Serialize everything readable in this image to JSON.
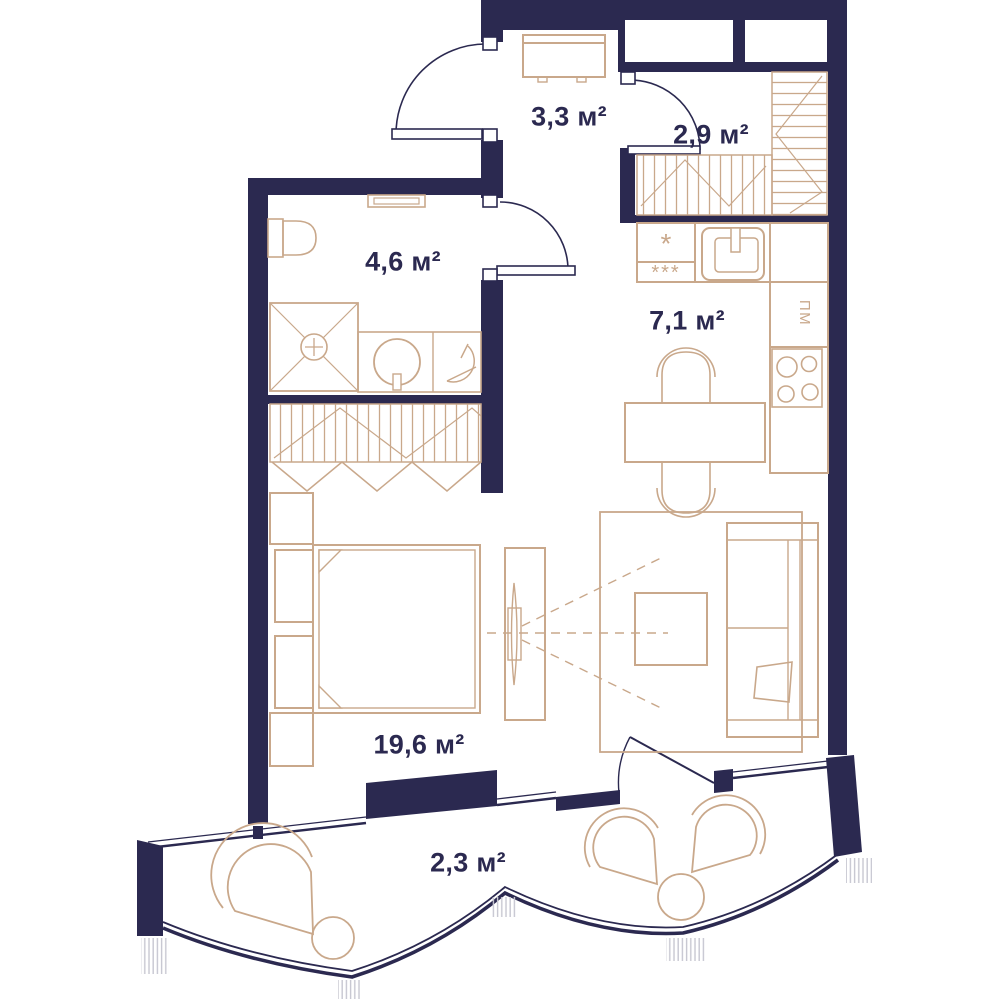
{
  "plan": {
    "type": "apartment-floor-plan",
    "rooms": [
      {
        "id": "hallway",
        "area_m2": 3.3,
        "area_label": "3,3 м²"
      },
      {
        "id": "dressing-room",
        "area_m2": 2.9,
        "area_label": "2,9 м²"
      },
      {
        "id": "bathroom",
        "area_m2": 4.6,
        "area_label": "4,6 м²"
      },
      {
        "id": "kitchen",
        "area_m2": 7.1,
        "area_label": "7,1 м²"
      },
      {
        "id": "living-room",
        "area_m2": 19.6,
        "area_label": "19,6 м²"
      },
      {
        "id": "balcony",
        "area_m2": 2.3,
        "area_label": "2,3 м²"
      }
    ],
    "annotations": {
      "dishwasher_label": "ПМ",
      "fridge_star": "*",
      "freezer_stars": "***"
    },
    "colors": {
      "wall": "#2b2950",
      "furniture": "#c9a88b",
      "text": "#2b2950",
      "hatch": "#c7c7d1",
      "background": "#ffffff"
    }
  }
}
